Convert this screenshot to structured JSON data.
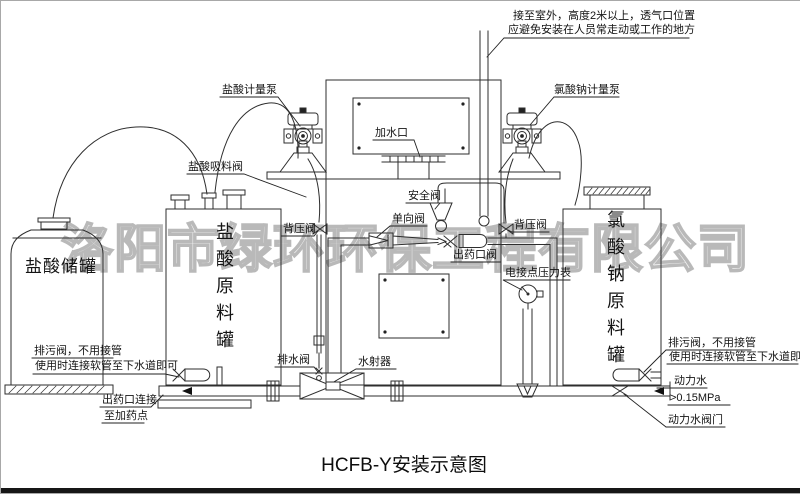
{
  "title": "HCFB-Y安装示意图",
  "watermark": "洛阳市绿环环保工程有限公司",
  "notes": {
    "vent": {
      "line1": "接至室外，高度2米以上，透气口位置",
      "line2": "应避免安装在人员常走动或工作的地方"
    },
    "blowdown_left": {
      "line1": "排污阀，不用接管",
      "line2": "使用时连接软管至下水道即可"
    },
    "blowdown_right": {
      "line1": "排污阀，不用接管",
      "line2": "使用时连接软管至下水道即可"
    },
    "outlet": {
      "line1": "出药口连接",
      "line2": "至加药点"
    },
    "power_water": {
      "name": "动力水",
      "pressure": ">0.15MPa",
      "valve": "动力水阀门"
    }
  },
  "labels": {
    "hcl_metering_pump": "盐酸计量泵",
    "naclo3_metering_pump": "氯酸钠计量泵",
    "hcl_suction_valve": "盐酸吸料阀",
    "water_fill_port": "加水口",
    "safety_valve": "安全阀",
    "check_valve": "单向阀",
    "back_pressure_valve_left": "背压阀",
    "back_pressure_valve_right": "背压阀",
    "dosing_outlet_valve": "出药口阀",
    "contact_pressure_gauge": "电接点压力表",
    "drain_valve": "排水阀",
    "water_ejector": "水射器"
  },
  "tanks": {
    "hcl_storage": "盐酸储罐",
    "hcl_raw": "盐酸原料罐",
    "naclo3_raw": "氯酸钠原料罐"
  },
  "colors": {
    "line": "#2e2e2e",
    "watermark": "#b9b9b9",
    "bottom_bar": "#161616"
  }
}
